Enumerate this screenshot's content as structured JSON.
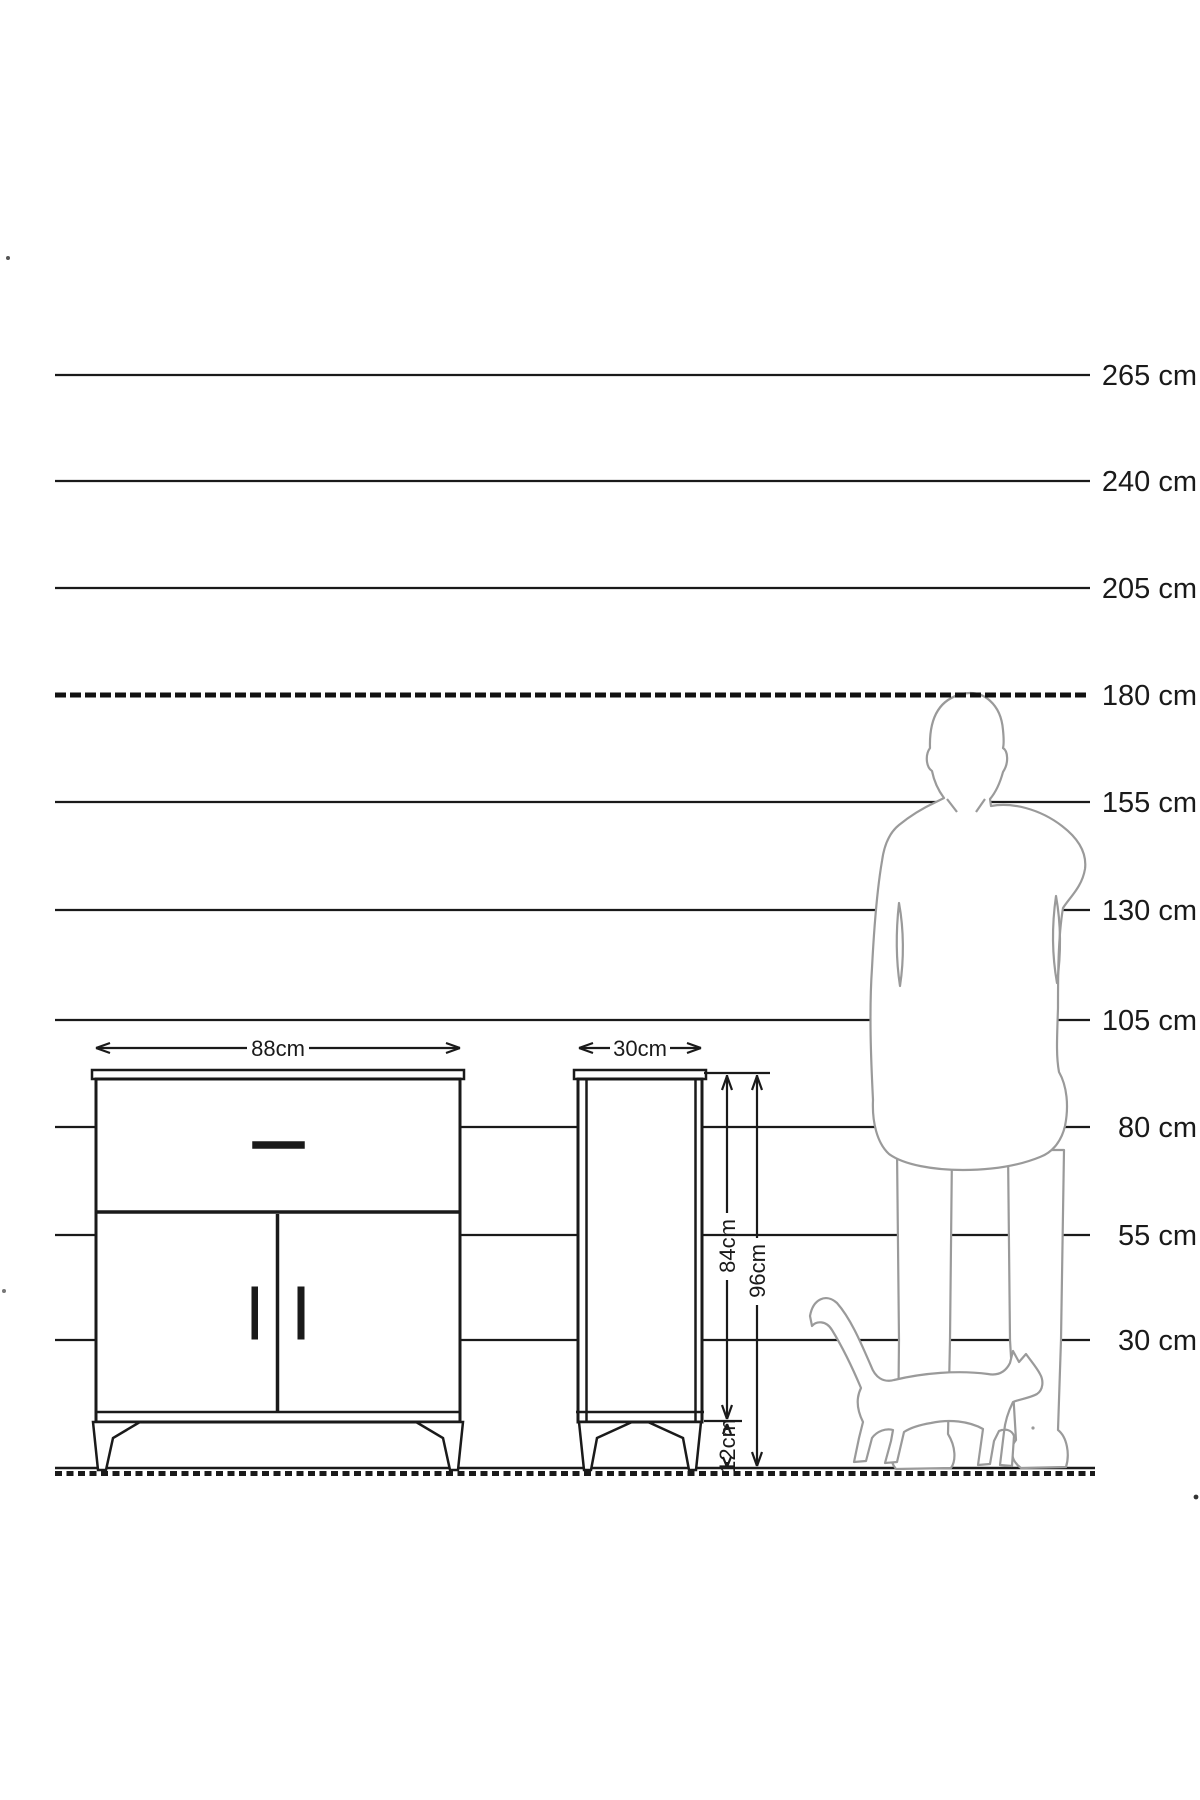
{
  "scale": {
    "unit": "cm",
    "lines": [
      {
        "label": "265 cm",
        "value": 265,
        "style": "solid"
      },
      {
        "label": "240 cm",
        "value": 240,
        "style": "solid"
      },
      {
        "label": "205 cm",
        "value": 205,
        "style": "solid"
      },
      {
        "label": "180 cm",
        "value": 180,
        "style": "dashed"
      },
      {
        "label": "155 cm",
        "value": 155,
        "style": "solid"
      },
      {
        "label": "130 cm",
        "value": 130,
        "style": "solid"
      },
      {
        "label": "105 cm",
        "value": 105,
        "style": "solid"
      },
      {
        "label": "80 cm",
        "value": 80,
        "style": "solid"
      },
      {
        "label": "55 cm",
        "value": 55,
        "style": "solid"
      },
      {
        "label": "30 cm",
        "value": 30,
        "style": "solid"
      }
    ]
  },
  "furniture": {
    "front_view": {
      "width_label": "88cm",
      "width_cm": 88
    },
    "side_view": {
      "depth_label": "30cm",
      "depth_cm": 30
    },
    "heights": {
      "body_label": "84cm",
      "body_cm": 84,
      "total_label": "96cm",
      "total_cm": 96,
      "legs_label": "12cm",
      "legs_cm": 12
    }
  },
  "silhouettes": {
    "man": "standing-man-silhouette",
    "cat": "walking-cat-silhouette"
  },
  "colors": {
    "line": "#1a1a1a",
    "silhouette": "#9a9a9a",
    "background": "#ffffff"
  }
}
